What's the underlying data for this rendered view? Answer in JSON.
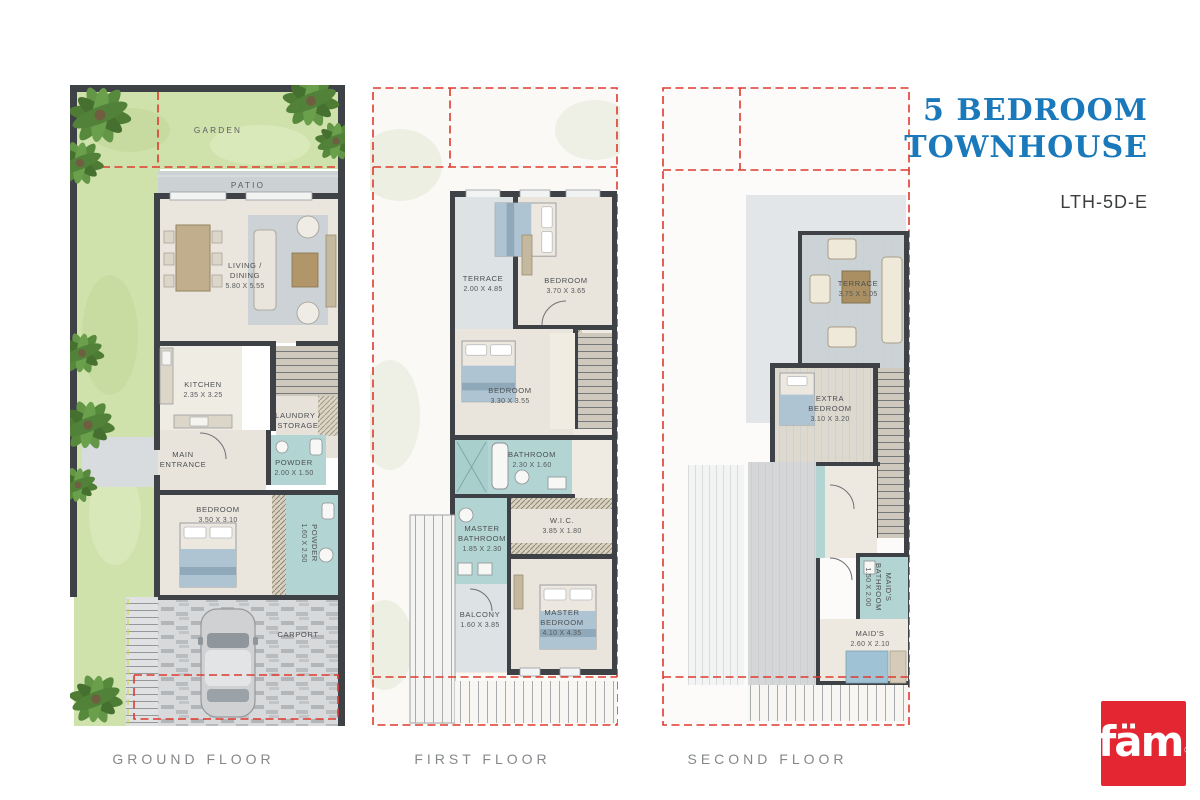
{
  "title": {
    "line1": "5 BEDROOM",
    "line2": "TOWNHOUSE",
    "unit_code": "LTH-5D-E",
    "accent_color": "#1a79ba"
  },
  "branding": {
    "logo_text": "fäm",
    "logo_registered": "®",
    "logo_bg": "#e42532"
  },
  "floors": {
    "ground": {
      "caption": "GROUND FLOOR",
      "garden": {
        "name": "GARDEN"
      },
      "patio": {
        "name": "PATIO"
      },
      "living": {
        "name1": "LIVING /",
        "name2": "DINING",
        "dims": "5.80 X 5.55"
      },
      "kitchen": {
        "name": "KITCHEN",
        "dims": "2.35 X 3.25"
      },
      "laundry": {
        "name1": "LAUNDRY /",
        "name2": "STORAGE"
      },
      "entrance": {
        "name1": "MAIN",
        "name2": "ENTRANCE"
      },
      "powder1": {
        "name": "POWDER",
        "dims": "2.00 X 1.50"
      },
      "bedroom": {
        "name": "BEDROOM",
        "dims": "3.50 X 3.10"
      },
      "powder2": {
        "name": "POWDER",
        "dims": "1.60 X 2.50"
      },
      "carport": {
        "name": "CARPORT"
      }
    },
    "first": {
      "caption": "FIRST FLOOR",
      "terrace": {
        "name": "TERRACE",
        "dims": "2.00 X 4.85"
      },
      "bedroom1": {
        "name": "BEDROOM",
        "dims": "3.70 X 3.65"
      },
      "bedroom2": {
        "name": "BEDROOM",
        "dims": "3.30 X 3.55"
      },
      "bathroom": {
        "name": "BATHROOM",
        "dims": "2.30 X 1.60"
      },
      "master_bath": {
        "name1": "MASTER",
        "name2": "BATHROOM",
        "dims": "1.85 X 2.30"
      },
      "wic": {
        "name": "W.I.C.",
        "dims": "3.85 X 1.80"
      },
      "balcony": {
        "name": "BALCONY",
        "dims": "1.60 X 3.85"
      },
      "master_bedroom": {
        "name1": "MASTER",
        "name2": "BEDROOM",
        "dims": "4.10 X 4.35"
      }
    },
    "second": {
      "caption": "SECOND FLOOR",
      "terrace": {
        "name": "TERRACE",
        "dims": "3.75 X 5.05"
      },
      "extra_bedroom": {
        "name1": "EXTRA",
        "name2": "BEDROOM",
        "dims": "3.10 X 3.20"
      },
      "bathroom": {
        "name": "BATHROOM",
        "dims": "1.60 X 2.55"
      },
      "maids_bath": {
        "name1": "MAID'S",
        "name2": "BATHROOM",
        "dims": "1.50 X 2.00"
      },
      "maids": {
        "name": "MAID'S",
        "dims": "2.60 X 2.10"
      }
    }
  }
}
